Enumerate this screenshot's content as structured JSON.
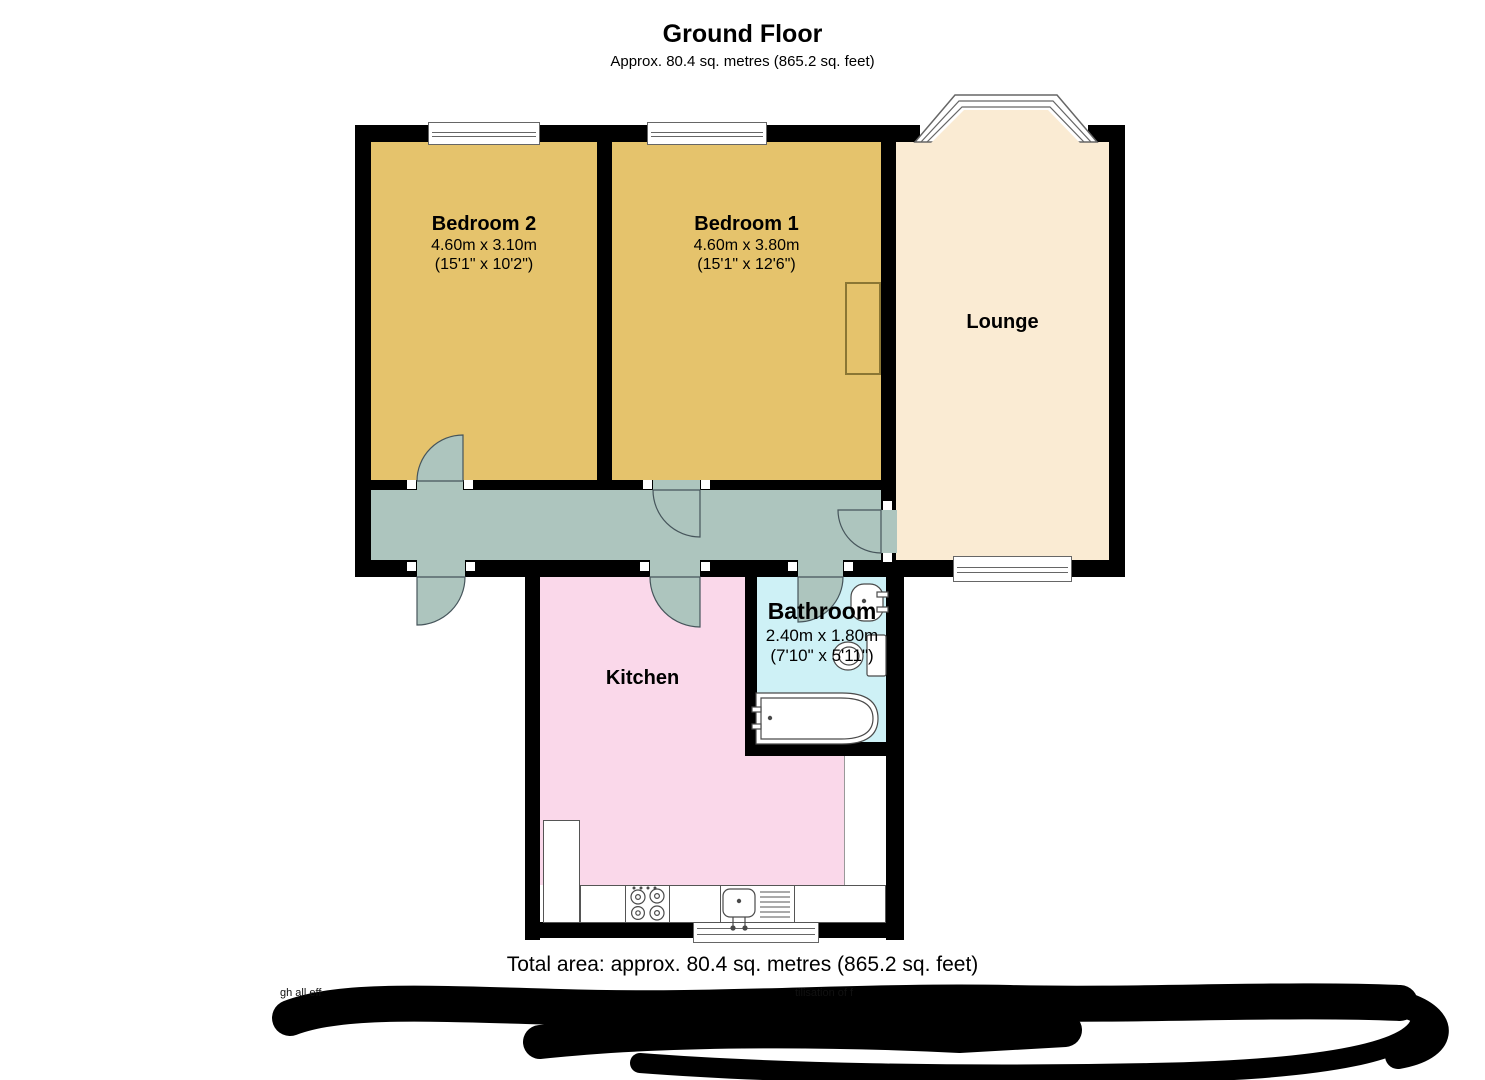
{
  "header": {
    "title": "Ground Floor",
    "subtitle": "Approx. 80.4 sq. metres (865.2 sq. feet)"
  },
  "rooms": {
    "bedroom2": {
      "label": "Bedroom 2",
      "dims_metric": "4.60m x 3.10m",
      "dims_imperial": "(15'1\" x 10'2\")",
      "color": "#E5C36C"
    },
    "bedroom1": {
      "label": "Bedroom 1",
      "dims_metric": "4.60m x 3.80m",
      "dims_imperial": "(15'1\" x 12'6\")",
      "color": "#E5C36C"
    },
    "lounge": {
      "label": "Lounge",
      "color": "#FAEBD3"
    },
    "kitchen": {
      "label": "Kitchen",
      "color": "#FAD8EA"
    },
    "bathroom": {
      "label": "Bathroom",
      "dims_metric": "2.40m x 1.80m",
      "dims_imperial": "(7'10\" x 5'11\")",
      "color": "#CEF1F6"
    },
    "hallway": {
      "color": "#ADC5BE"
    }
  },
  "colors": {
    "wall": "#000000",
    "fixture_stroke": "#4a4a4a",
    "window_frame": "#666666"
  },
  "footer": {
    "total_area": "Total area: approx. 80.4 sq. metres (865.2 sq. feet)",
    "redacted_fragment_left": "gh all eff",
    "redacted_fragment_right": "tilisation of f"
  }
}
